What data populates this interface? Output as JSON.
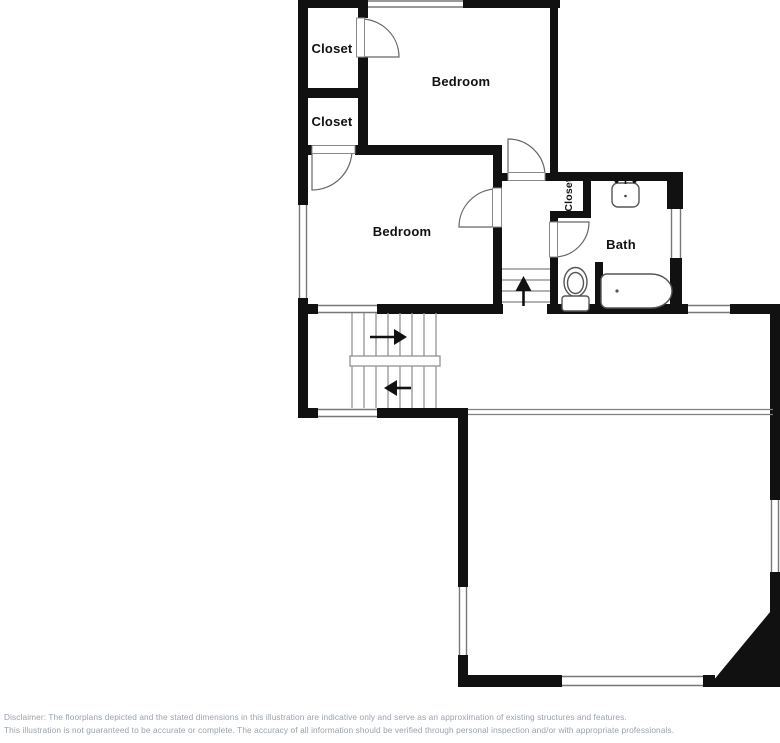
{
  "title": "Floor plan illustration",
  "labels": {
    "closet_top": "Closet",
    "bedroom_upper": "Bedroom",
    "closet_middle": "Closet",
    "bedroom_middle": "Bedroom",
    "closet_hall": "Closet",
    "bath": "Bath"
  },
  "icons": {
    "stair_up_arrow": "arrow-up",
    "stair_right_arrow": "arrow-right",
    "stair_left_arrow": "arrow-left",
    "fixtures": [
      "sink",
      "toilet",
      "bathtub"
    ]
  },
  "disclaimer": {
    "line1": "Disclaimer: The floorplans depicted and the stated dimensions in this illustration are indicative only and serve as an approximation of existing structures and features.",
    "line2": "This illustration is not guaranteed to be accurate or complete. The accuracy of all information should be verified through personal inspection and/or with appropriate professionals."
  },
  "colors": {
    "wall": "#111111",
    "window_line": "#777777",
    "stair_tread": "#9a9a9a",
    "disclaimer_text": "#9aa2ab",
    "background": "#ffffff"
  }
}
